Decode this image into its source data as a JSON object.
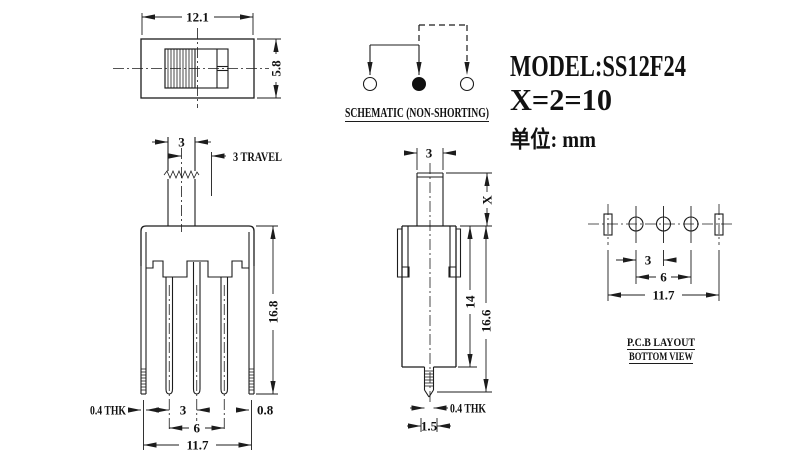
{
  "drawing": {
    "model": "MODEL:SS12F24",
    "x_note": "X=2=10",
    "unit_note": "单位: mm"
  },
  "top_view": {
    "dim_width": "12.1",
    "dim_height": "5.8"
  },
  "front_view": {
    "dim_knob_w": "3",
    "dim_travel": "3 TRAVEL",
    "dim_height": "16.8",
    "dim_thk": "0.4 THK",
    "dim_pitch": "3",
    "dim_span": "6",
    "dim_pin_w": "0.8",
    "dim_total_w": "11.7"
  },
  "side_view": {
    "dim_knob_w": "3",
    "dim_x": "X",
    "dim_body_h": "14",
    "dim_total_h": "16.6",
    "dim_thk": "0.4 THK",
    "dim_pin_w": "1.5"
  },
  "schematic": {
    "label": "SCHEMATIC (NON-SHORTING)"
  },
  "pcb": {
    "dim_pitch": "3",
    "dim_span": "6",
    "dim_total_w": "11.7",
    "label_line1": "P.C.B LAYOUT",
    "label_line2": "BOTTOM VIEW"
  }
}
